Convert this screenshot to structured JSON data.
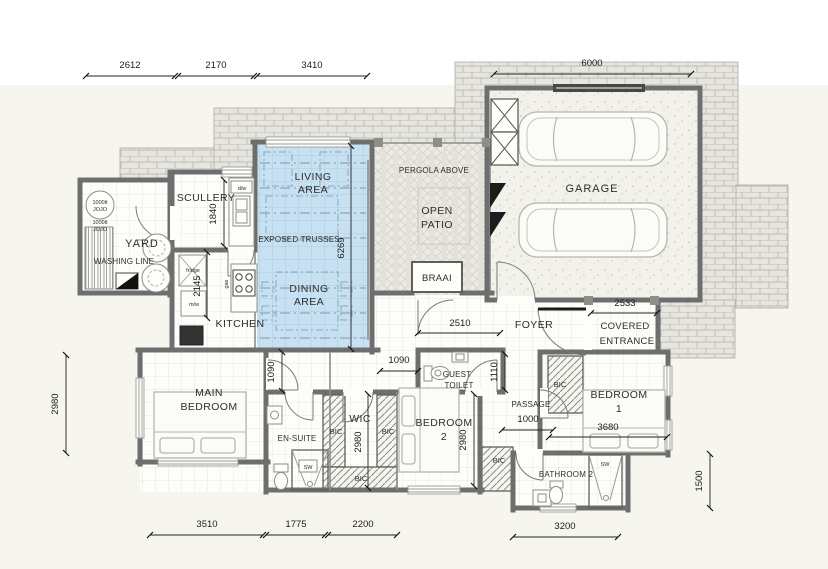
{
  "rooms": {
    "living": [
      "LIVING",
      "AREA"
    ],
    "dining": [
      "DINING",
      "AREA"
    ],
    "exposed_trusses": "EXPOSED TRUSSES",
    "pergola": "PERGOLA ABOVE",
    "open_patio": [
      "OPEN",
      "PATIO"
    ],
    "braai": "BRAAI",
    "garage": "GARAGE",
    "scullery": "SCULLERY",
    "yard": "YARD",
    "washing_line": "WASHING LINE",
    "kitchen": "KITCHEN",
    "foyer": "FOYER",
    "covered_entrance": [
      "COVERED",
      "ENTRANCE"
    ],
    "main_bedroom": [
      "MAIN",
      "BEDROOM"
    ],
    "ensuite": "EN-SUITE",
    "wic": "WIC",
    "bedroom2": [
      "BEDROOM",
      "2"
    ],
    "guest_toilet": [
      "GUEST",
      "TOILET"
    ],
    "passage": "PASSAGE",
    "bedroom1": [
      "BEDROOM",
      "1"
    ],
    "bathroom2": "BATHROOM 2"
  },
  "fixtures": {
    "bic": "BIC",
    "shower": "SW",
    "fridge": "fridge",
    "microwave": "m/w",
    "gas": "gas",
    "dishwasher": "d/w",
    "tank": [
      "1000lt",
      "JOJO"
    ]
  },
  "dims": {
    "top": [
      "2612",
      "2170",
      "3410"
    ],
    "garage_w": "6000",
    "scullery_d": "1840",
    "kitchen_d": "2145",
    "living_d": "6269",
    "foyer_w": "2510",
    "entrance_w": "2533",
    "offset_main": "1090",
    "offset_guest": "1090",
    "guest_d": "1110",
    "left_d": "2980",
    "wic_d": "2980",
    "bed2_d": "2980",
    "passage_w": "1000",
    "bed1_w": "3680",
    "right_d": "1500",
    "bottom": [
      "3510",
      "1775",
      "2200"
    ],
    "bath_w": "3200"
  },
  "colors": {
    "living_fill": "#c7e1f2",
    "wall": "#6e6e6e",
    "paving": "#e6e5df",
    "background": "#f7f6ee"
  }
}
